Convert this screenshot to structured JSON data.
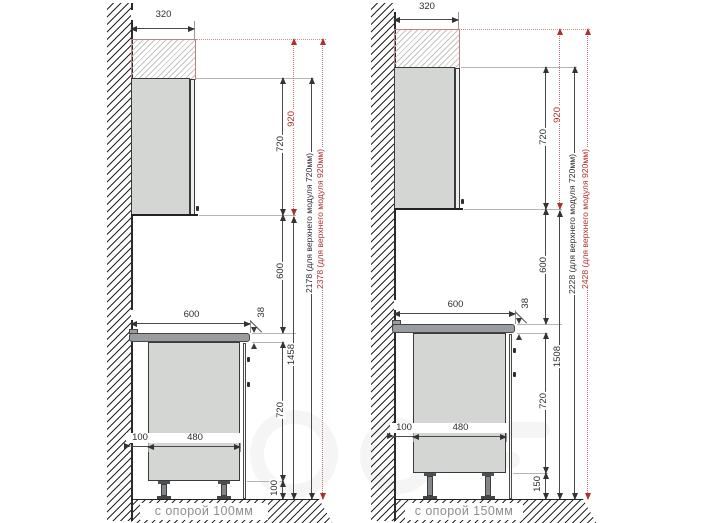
{
  "title": "kitchen-cabinet-mounting-heights-diagram",
  "colors": {
    "dimension": "#3a3a3a",
    "highlight_red": "#b03030",
    "cabinet_fill": "#d3d6d3",
    "countertop_fill": "#9a9da0",
    "hatch_zone_border": "#b78383"
  },
  "diagrams": [
    {
      "caption": "с опорой 100мм",
      "dims": {
        "upper_width": "320",
        "upper_height": "720",
        "upper_height_alt": "920",
        "gap_height": "600",
        "countertop_width": "600",
        "countertop_thickness": "38",
        "wall_gap": "100",
        "base_depth": "480",
        "base_height": "720",
        "leg_height": "100",
        "upper_bottom_height": "1458",
        "total_for_720": "2178 (для верхнего модуля 720мм)",
        "total_for_920": "2378 (для верхнего модуля 920мм)"
      }
    },
    {
      "caption": "с опорой 150мм",
      "dims": {
        "upper_width": "320",
        "upper_height": "720",
        "upper_height_alt": "920",
        "gap_height": "600",
        "countertop_width": "600",
        "countertop_thickness": "38",
        "wall_gap": "100",
        "base_depth": "480",
        "base_height": "720",
        "leg_height": "150",
        "upper_bottom_height": "1508",
        "total_for_720": "2228 (для верхнего модуля 720мм)",
        "total_for_920": "2428 (для верхнего модуля 920мм)"
      }
    }
  ]
}
